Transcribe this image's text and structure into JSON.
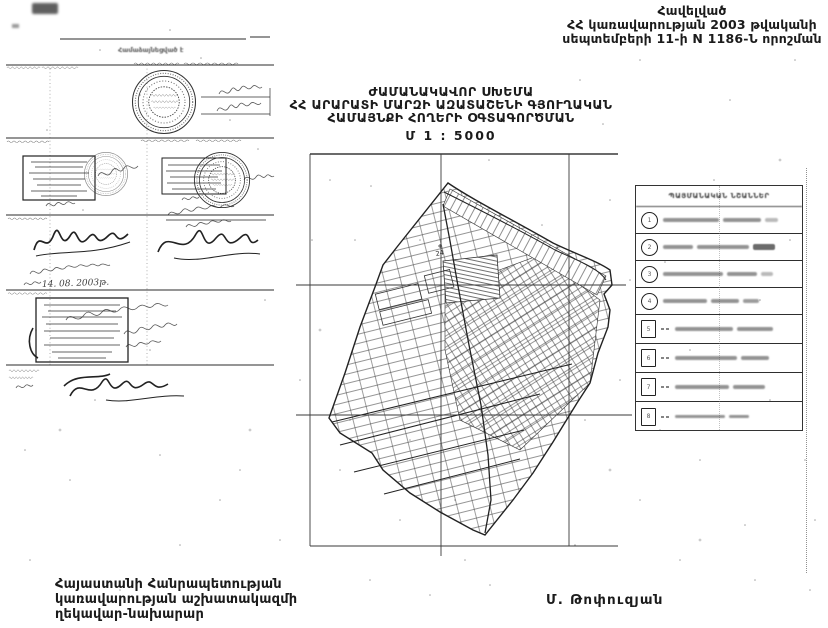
{
  "page": {
    "paper_color": "#ffffff",
    "ink_color": "#1b1b1b"
  },
  "annex_note": {
    "line1": "Հավելված",
    "line2": "ՀՀ կառավարության 2003 թվականի",
    "line3": "սեպտեմբերի 11-ի N 1186-Ն որոշման"
  },
  "title_block": {
    "line1": "ԺԱՄԱՆԱԿԱՎՈՐ ՍԽԵՄԱ",
    "line2": "ՀՀ ԱՐԱՐԱՏԻ ՄԱՐԶԻ ԱԶԱՏԱՇԵՆԻ ԳՅՈՒՂԱԿԱՆ",
    "line3": "ՀԱՄԱՅՆՔԻ ՀՈՂԵՐԻ ՕԳՏԱԳՈՐԾՄԱՆ",
    "scale": "Մ 1 : 5000"
  },
  "approvals_panel": {
    "header_blurred": "Համաձայնեցված է",
    "handwritten_date": "14. 08. 2003թ."
  },
  "map": {
    "parcel_label": "24"
  },
  "legend": {
    "title": "ՊԱՅՄԱՆԱԿԱՆ ՆՇԱՆՆԵՐ",
    "rows": [
      {
        "num": "1",
        "symbol": "circle"
      },
      {
        "num": "2",
        "symbol": "circle"
      },
      {
        "num": "3",
        "symbol": "circle"
      },
      {
        "num": "4",
        "symbol": "circle"
      },
      {
        "num": "5",
        "symbol": "square"
      },
      {
        "num": "6",
        "symbol": "square"
      },
      {
        "num": "7",
        "symbol": "square"
      },
      {
        "num": "8",
        "symbol": "square"
      }
    ]
  },
  "footer": {
    "line1": "Հայաստանի Հանրապետության",
    "line2": "կառավարության աշխատակազմի",
    "line3": "ղեկավար-նախարար",
    "signature_name": "Մ. Թոփուզյան"
  }
}
